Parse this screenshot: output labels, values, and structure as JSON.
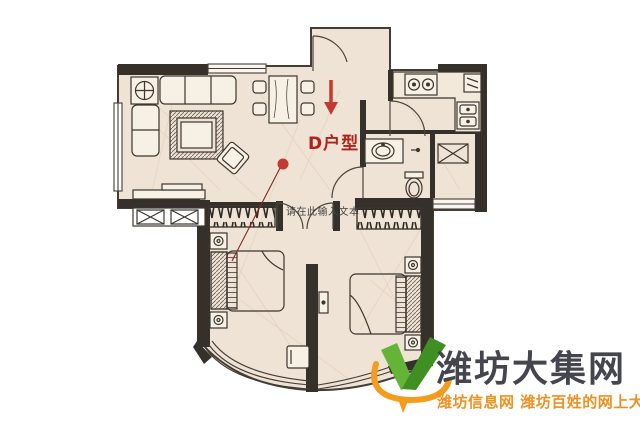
{
  "page": {
    "background": "#ffffff",
    "width": 640,
    "height": 427
  },
  "floorplan": {
    "unit_label": "D户型",
    "placeholder_text": "请在此输入文本",
    "annotations": {
      "entry_arrow_icon": "down-arrow-icon",
      "marker_icon": "red-dot-marker"
    },
    "colors": {
      "floor": "#eee3d4",
      "wall": "#36302a",
      "line": "#443d35",
      "annotation_red": "#c43a30",
      "unit_label_red": "#b0211d",
      "placeholder_gray": "#454545"
    }
  },
  "watermark": {
    "site_name": "潍坊大集网",
    "tagline": "潍坊信息网 潍坊百姓的网上大集",
    "logo_icon": "v-check-logo",
    "colors": {
      "site_name": "#45454e",
      "tagline": "#ef9120",
      "logo_green": "#63b437",
      "logo_green_dark": "#3f8f22",
      "logo_orange": "#f59b1e"
    }
  }
}
